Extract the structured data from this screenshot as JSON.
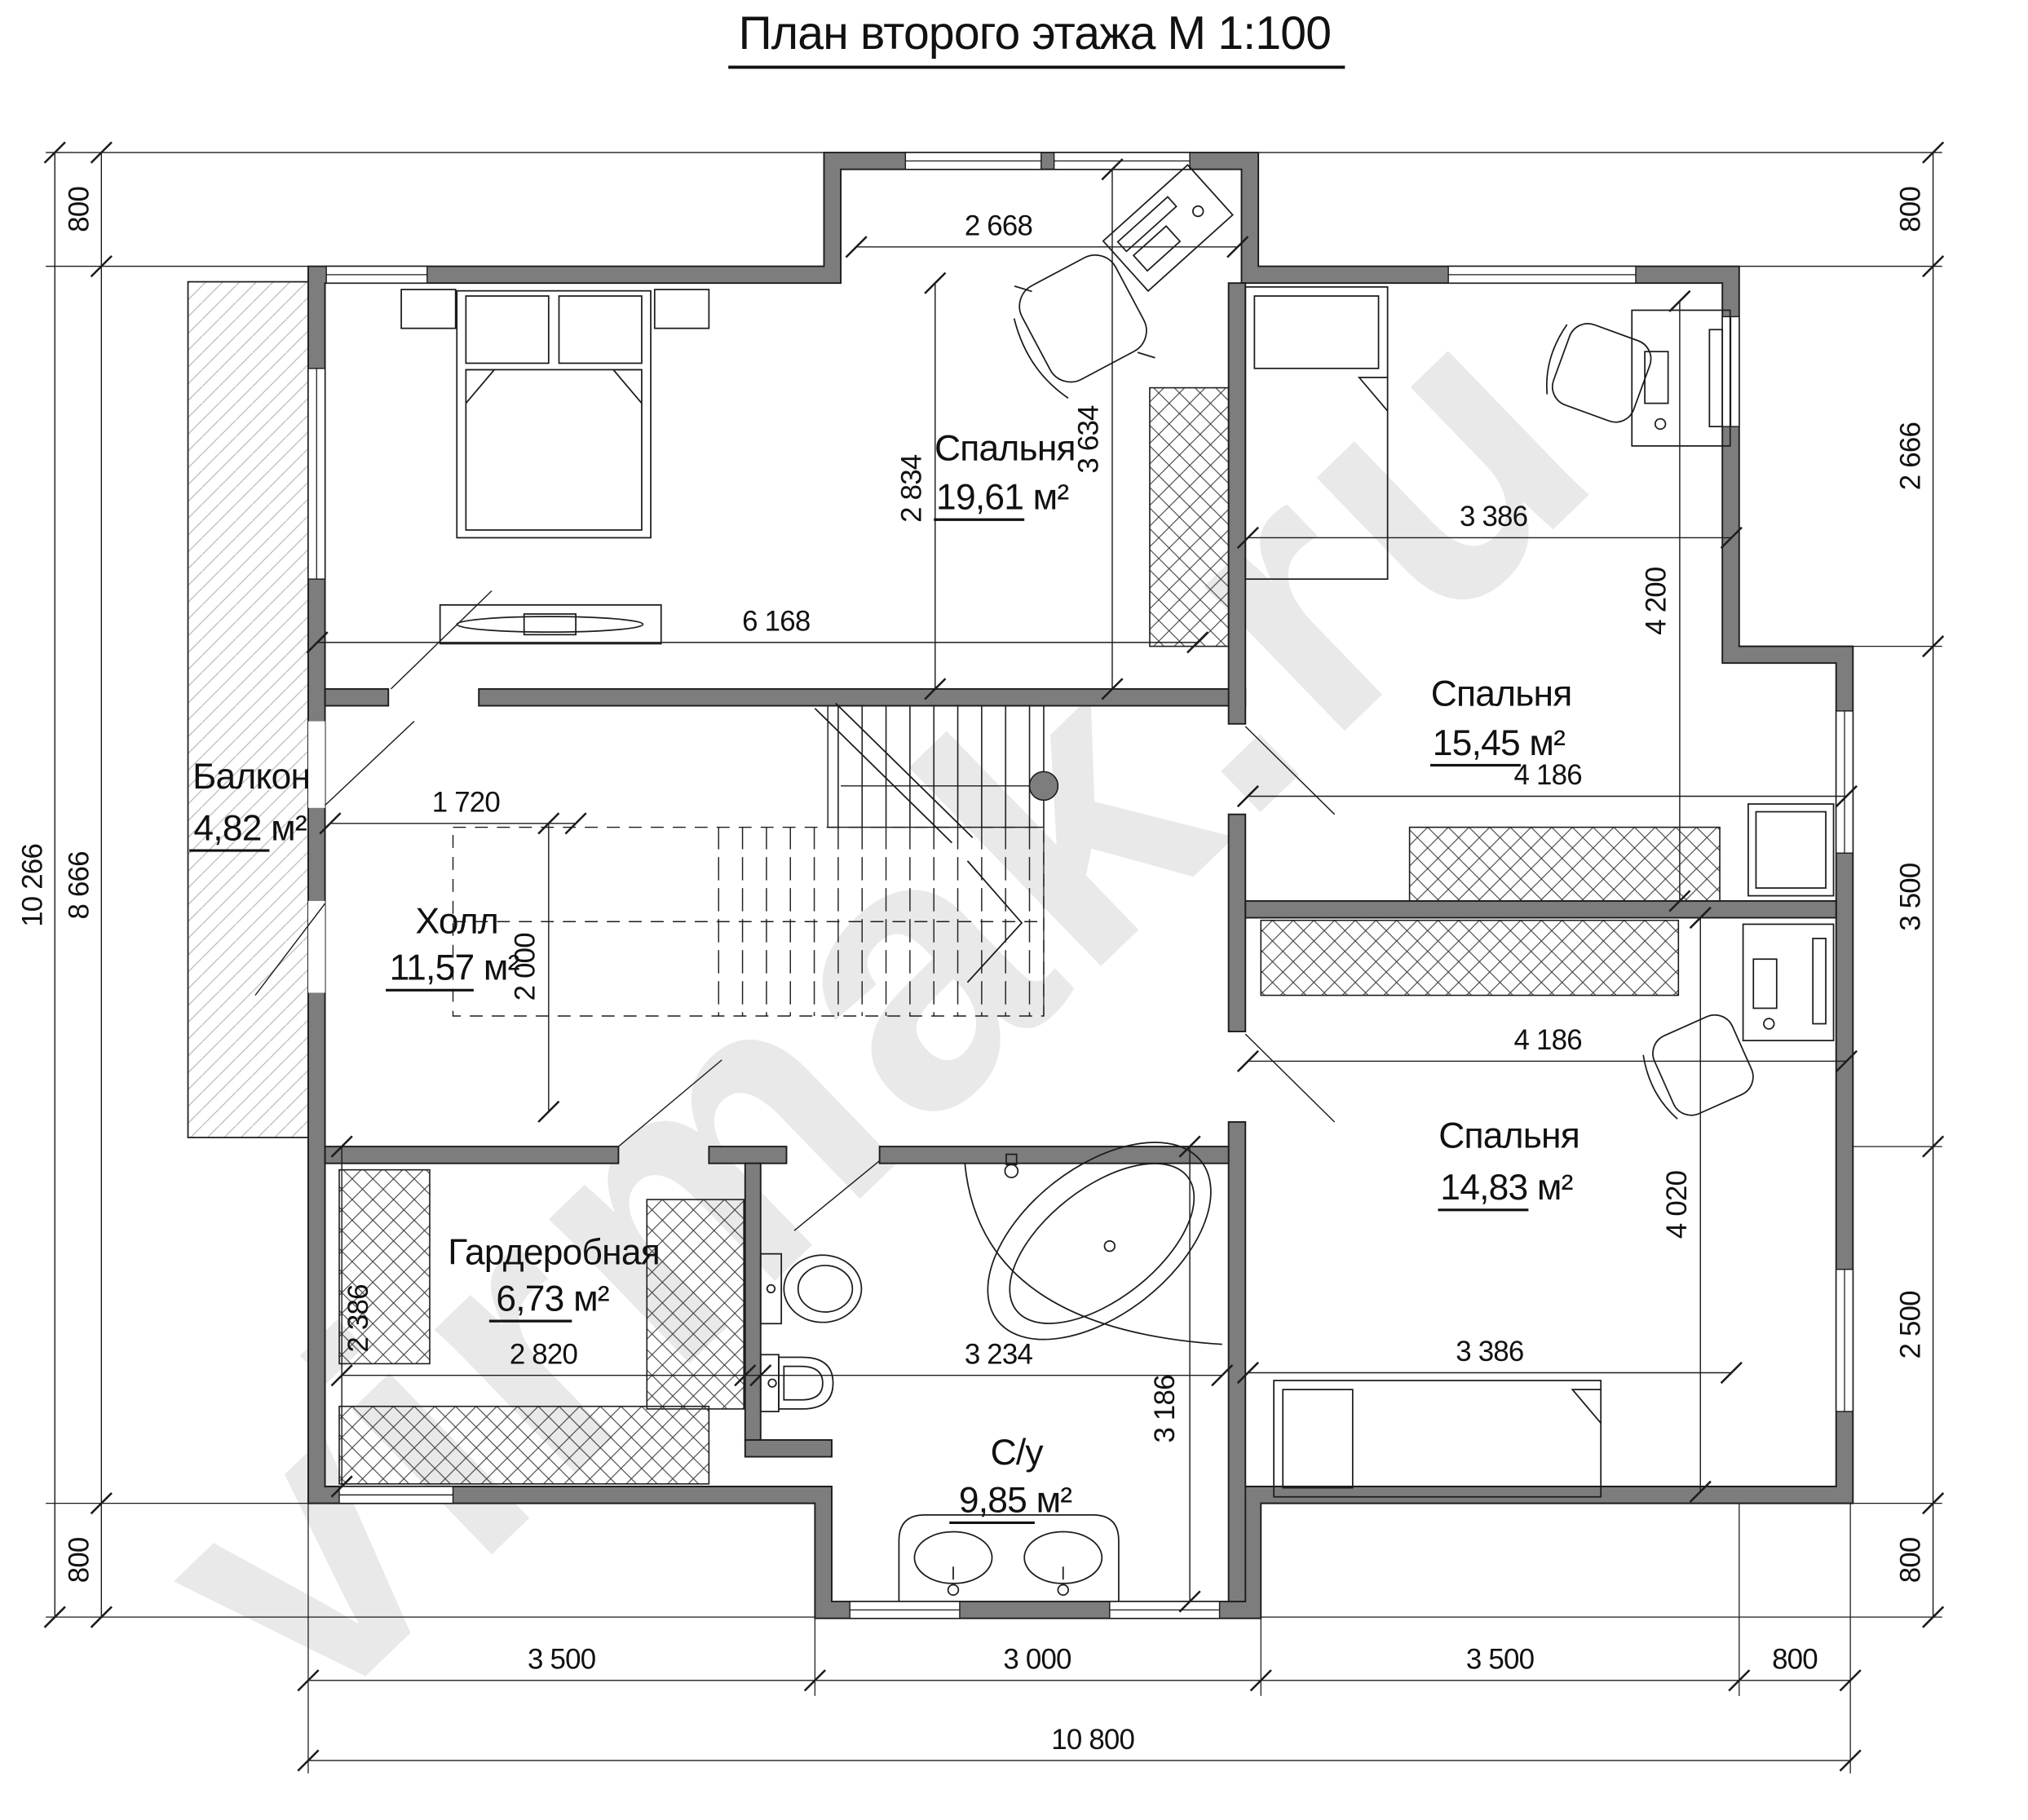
{
  "title": {
    "text": "План второго этажа М 1:100"
  },
  "watermark": {
    "text": "virmak.ru"
  },
  "rooms": {
    "bedroom1": {
      "name": "Спальня",
      "area": "19,61 м²"
    },
    "bedroom2": {
      "name": "Спальня",
      "area": "15,45 м²"
    },
    "bedroom3": {
      "name": "Спальня",
      "area": "14,83 м²"
    },
    "hall": {
      "name": "Холл",
      "area": "11,57 м²"
    },
    "balcony": {
      "name": "Балкон",
      "area": "4,82 м²"
    },
    "wardrobe": {
      "name": "Гардеробная",
      "area": "6,73 м²"
    },
    "bathroom": {
      "name": "С/у",
      "area": "9,85 м²"
    }
  },
  "dims": {
    "left_total": "10 266",
    "left_top": "800",
    "left_mid": "8 666",
    "left_bottom": "800",
    "right_1": "800",
    "right_2": "2 666",
    "right_3": "3 500",
    "right_4": "2 500",
    "right_5": "800",
    "bottom_1": "3 500",
    "bottom_2": "3 000",
    "bottom_3": "3 500",
    "bottom_4": "800",
    "bottom_total": "10 800",
    "b1_top_window": "2 668",
    "b1_width": "6 168",
    "b1_depth": "2 834",
    "b1_depth_full": "3 634",
    "b2_width": "3 386",
    "b2_depth": "4 200",
    "b2_width_full": "4 186",
    "b3_width_full": "4 186",
    "b3_depth": "4 020",
    "b3_width": "3 386",
    "hall_width": "1 720",
    "hall_depth": "2 000",
    "wardrobe_depth": "2 386",
    "wardrobe_width": "2 820",
    "bathroom_width": "3 234",
    "bathroom_depth": "3 186"
  },
  "colors": {
    "wall": "#7d7d7d",
    "line": "#1c1c1c",
    "watermark": "#e9e9e9"
  }
}
